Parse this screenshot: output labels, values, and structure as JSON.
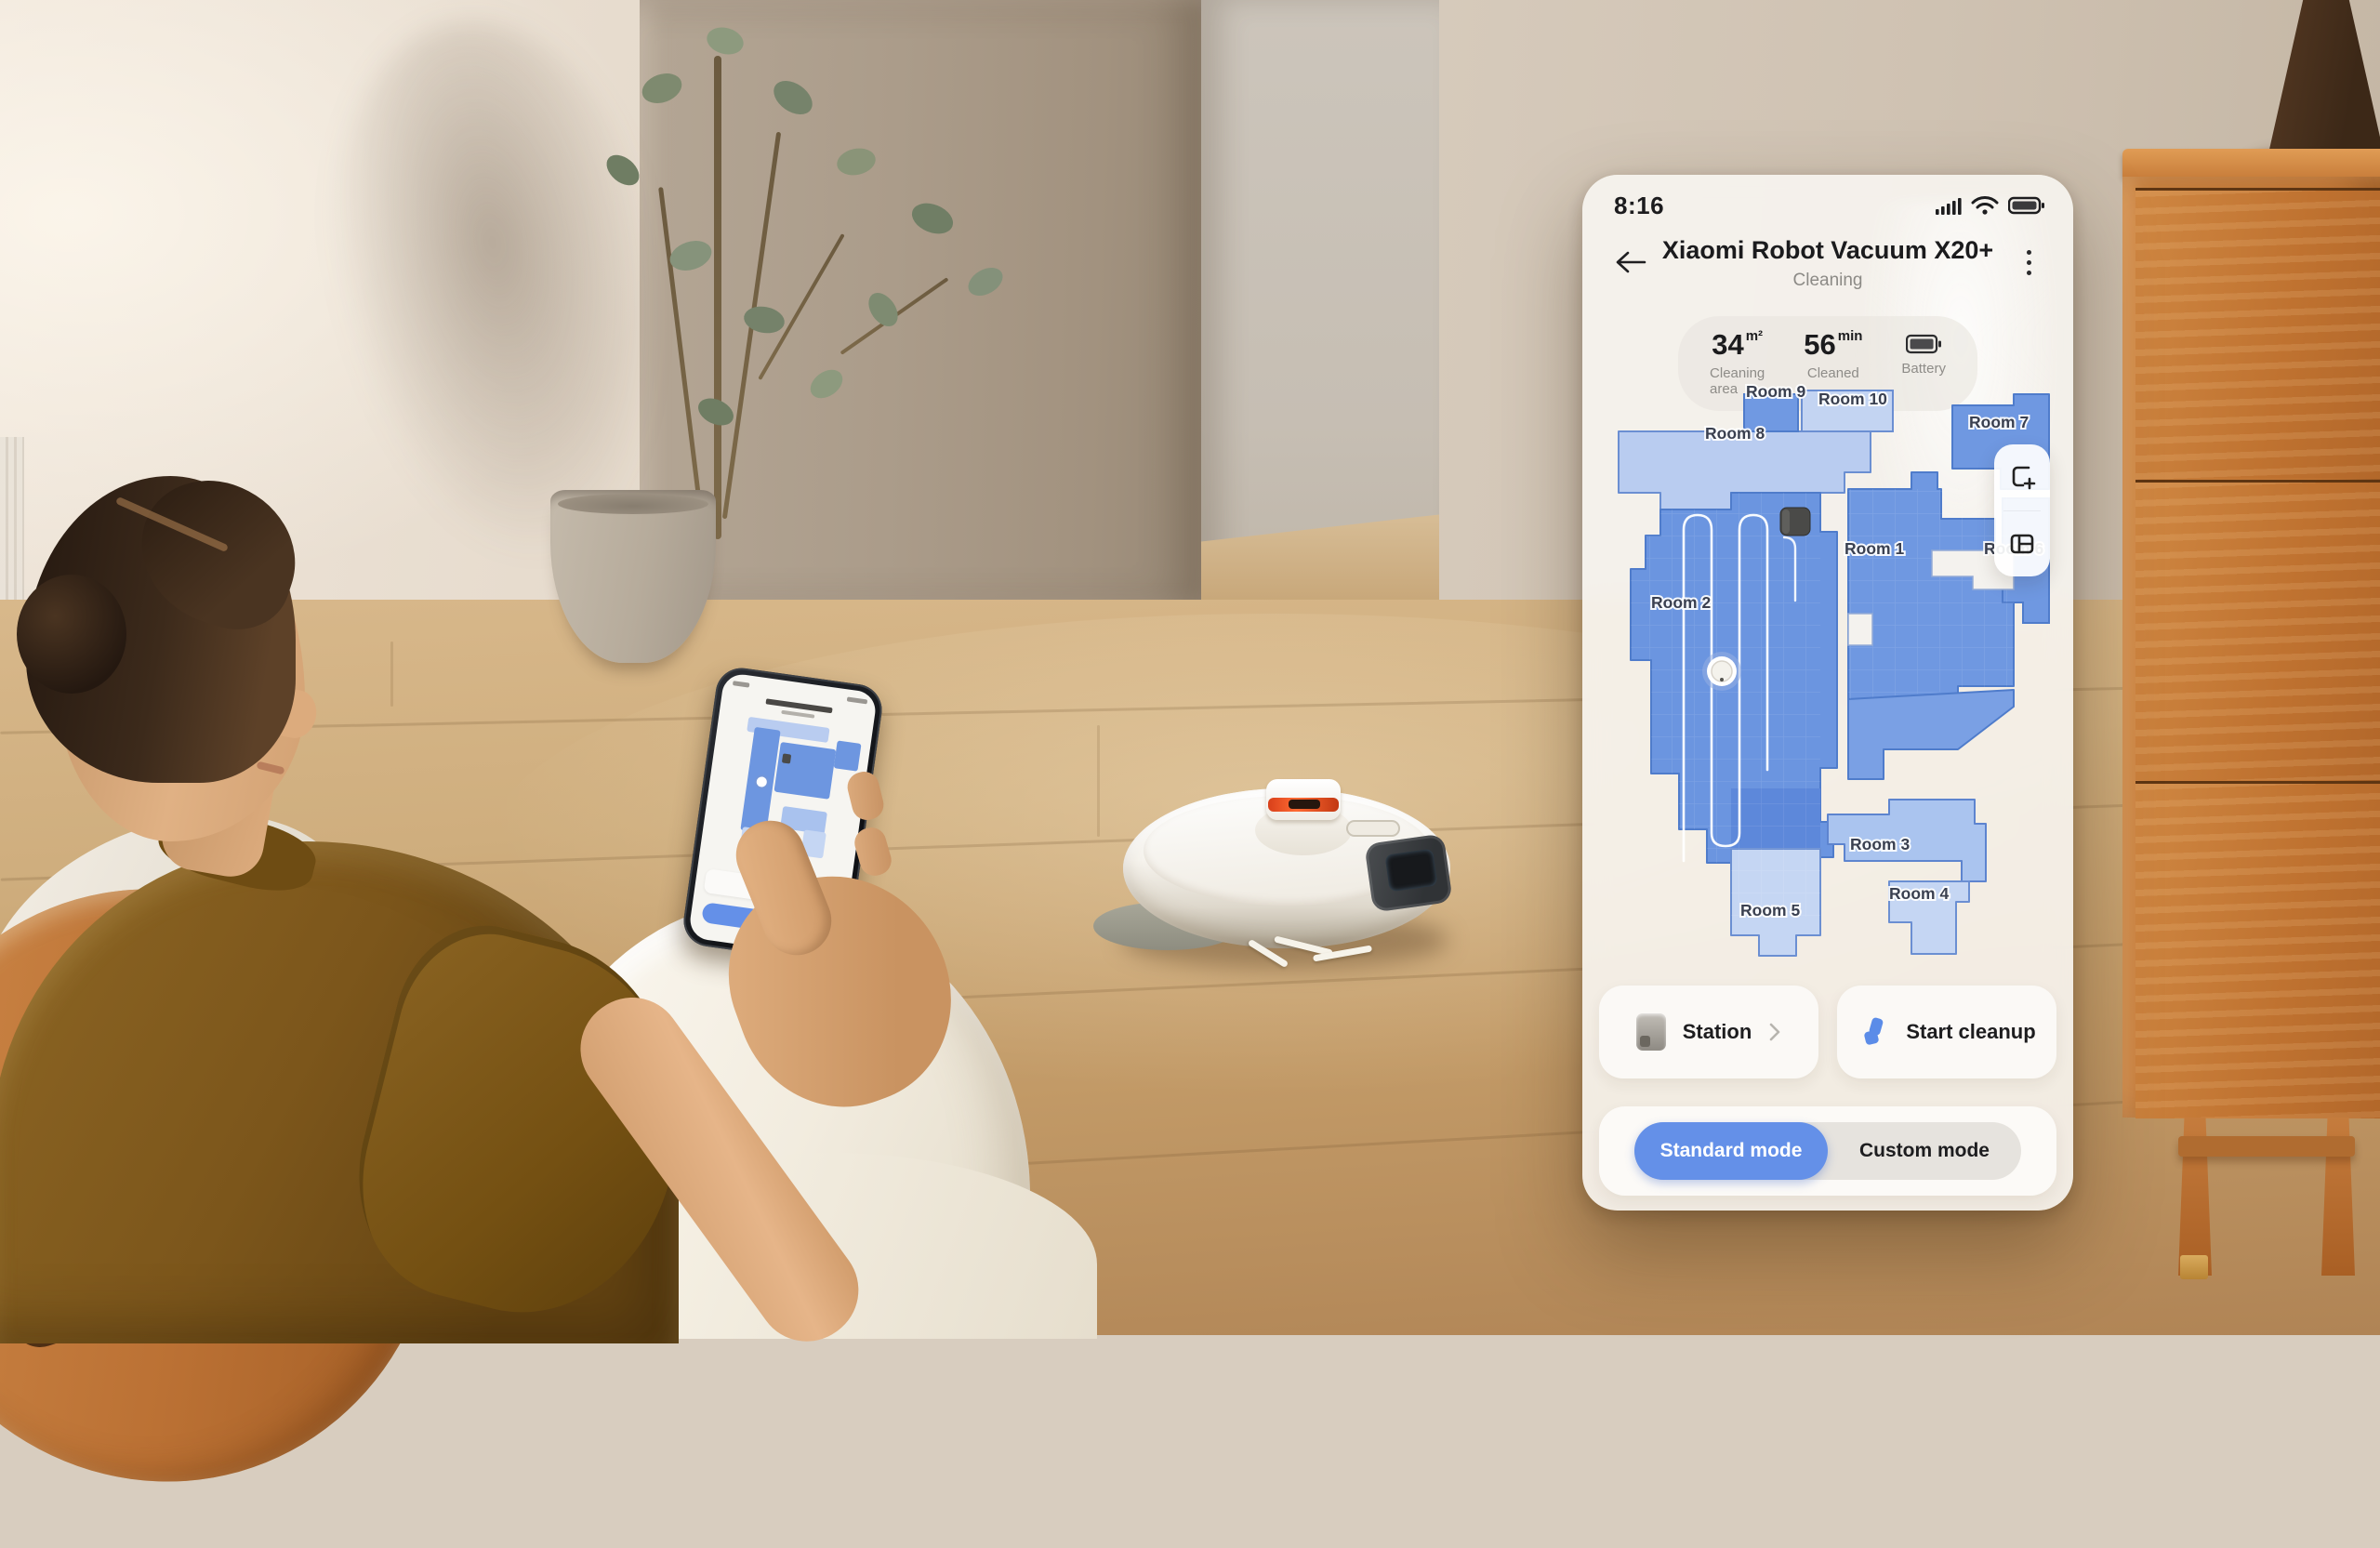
{
  "colors": {
    "accent_blue": "#6490e8",
    "map_room_medium": "#6e97e1",
    "map_room_medium_border": "#4f7ccb",
    "map_room_light": "#c2d3f2",
    "map_room_midlight": "#a9c2ee",
    "map_path_white": "#ffffff",
    "panel_bg": "#f7f5f1"
  },
  "status_bar": {
    "time": "8:16"
  },
  "header": {
    "title": "Xiaomi Robot Vacuum X20+",
    "subtitle": "Cleaning"
  },
  "stats": {
    "area": {
      "value": "34",
      "unit": "m²",
      "label": "Cleaning area"
    },
    "time": {
      "value": "56",
      "unit": "min",
      "label": "Cleaned"
    },
    "battery": {
      "label": "Battery"
    }
  },
  "map": {
    "rooms": [
      {
        "label": "Room 9",
        "tone": "medium"
      },
      {
        "label": "Room 10",
        "tone": "light"
      },
      {
        "label": "Room 7",
        "tone": "medium"
      },
      {
        "label": "Room 8",
        "tone": "light"
      },
      {
        "label": "Room 1",
        "tone": "medium"
      },
      {
        "label": "Room 6",
        "tone": "medium"
      },
      {
        "label": "Room 2",
        "tone": "medium"
      },
      {
        "label": "Room 3",
        "tone": "midlight"
      },
      {
        "label": "Room 4",
        "tone": "light"
      },
      {
        "label": "Room 5",
        "tone": "light"
      }
    ],
    "markers": {
      "station": "dock-station",
      "robot": "robot-position"
    }
  },
  "actions": {
    "station_label": "Station",
    "start_cleanup_label": "Start cleanup"
  },
  "mode_toggle": {
    "selected": "Standard mode",
    "options": [
      {
        "label": "Standard mode"
      },
      {
        "label": "Custom mode"
      }
    ]
  }
}
